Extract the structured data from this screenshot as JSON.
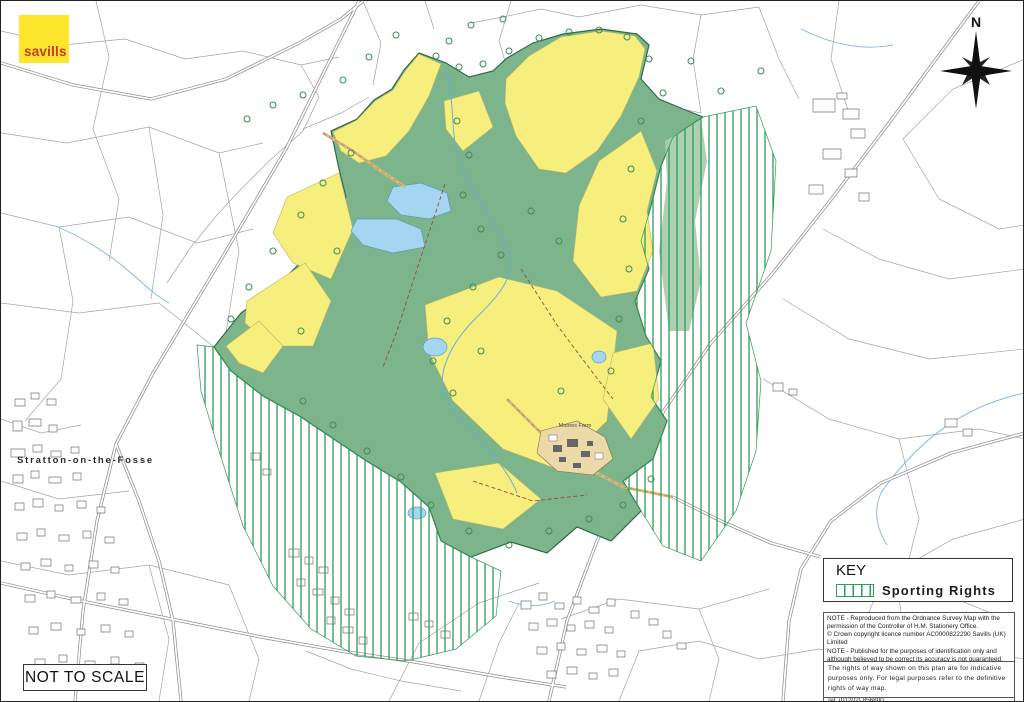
{
  "brand": {
    "name": "savills"
  },
  "compass": {
    "north_label": "N"
  },
  "map": {
    "village_label": "Stratton-on-the-Fosse",
    "farm_label": "Moores Farm"
  },
  "scale_box": {
    "label": "NOT TO SCALE"
  },
  "key": {
    "title": "KEY",
    "items": [
      {
        "label": "Sporting Rights",
        "swatch": "green-vertical-hatch"
      }
    ]
  },
  "notes": {
    "note1": "NOTE - Reproduced from the Ordnance Survey Map with the permission of the Controller of H.M. Stationery Office.",
    "note2": "© Crown copyright licence number AC0000822290 Savills (UK) Limited",
    "note3": "NOTE - Published for the purposes of identification only and although believed to be correct its accuracy is not guaranteed.",
    "ref": "MCL: 33324/Moores Farm_r2",
    "date": "Date: 07/03/2025",
    "team": "The Cartographic & Design Team, Wessex House, Wimborne, Dorset, BH21 1PB\nTel: (01202) 856800",
    "rights": "The rights of way shown on this plan are for indicative purposes only. For legal purposes refer to the definitive rights of way map."
  },
  "colors": {
    "brand_yellow": "#fde62c",
    "brand_red": "#c23b2a",
    "field_yellow": "#f6ef7d",
    "woodland_green": "#7cb48b",
    "hatch_green": "#2f9e57",
    "water_blue": "#a5d6f1",
    "building_tan": "#ecd9a8"
  }
}
